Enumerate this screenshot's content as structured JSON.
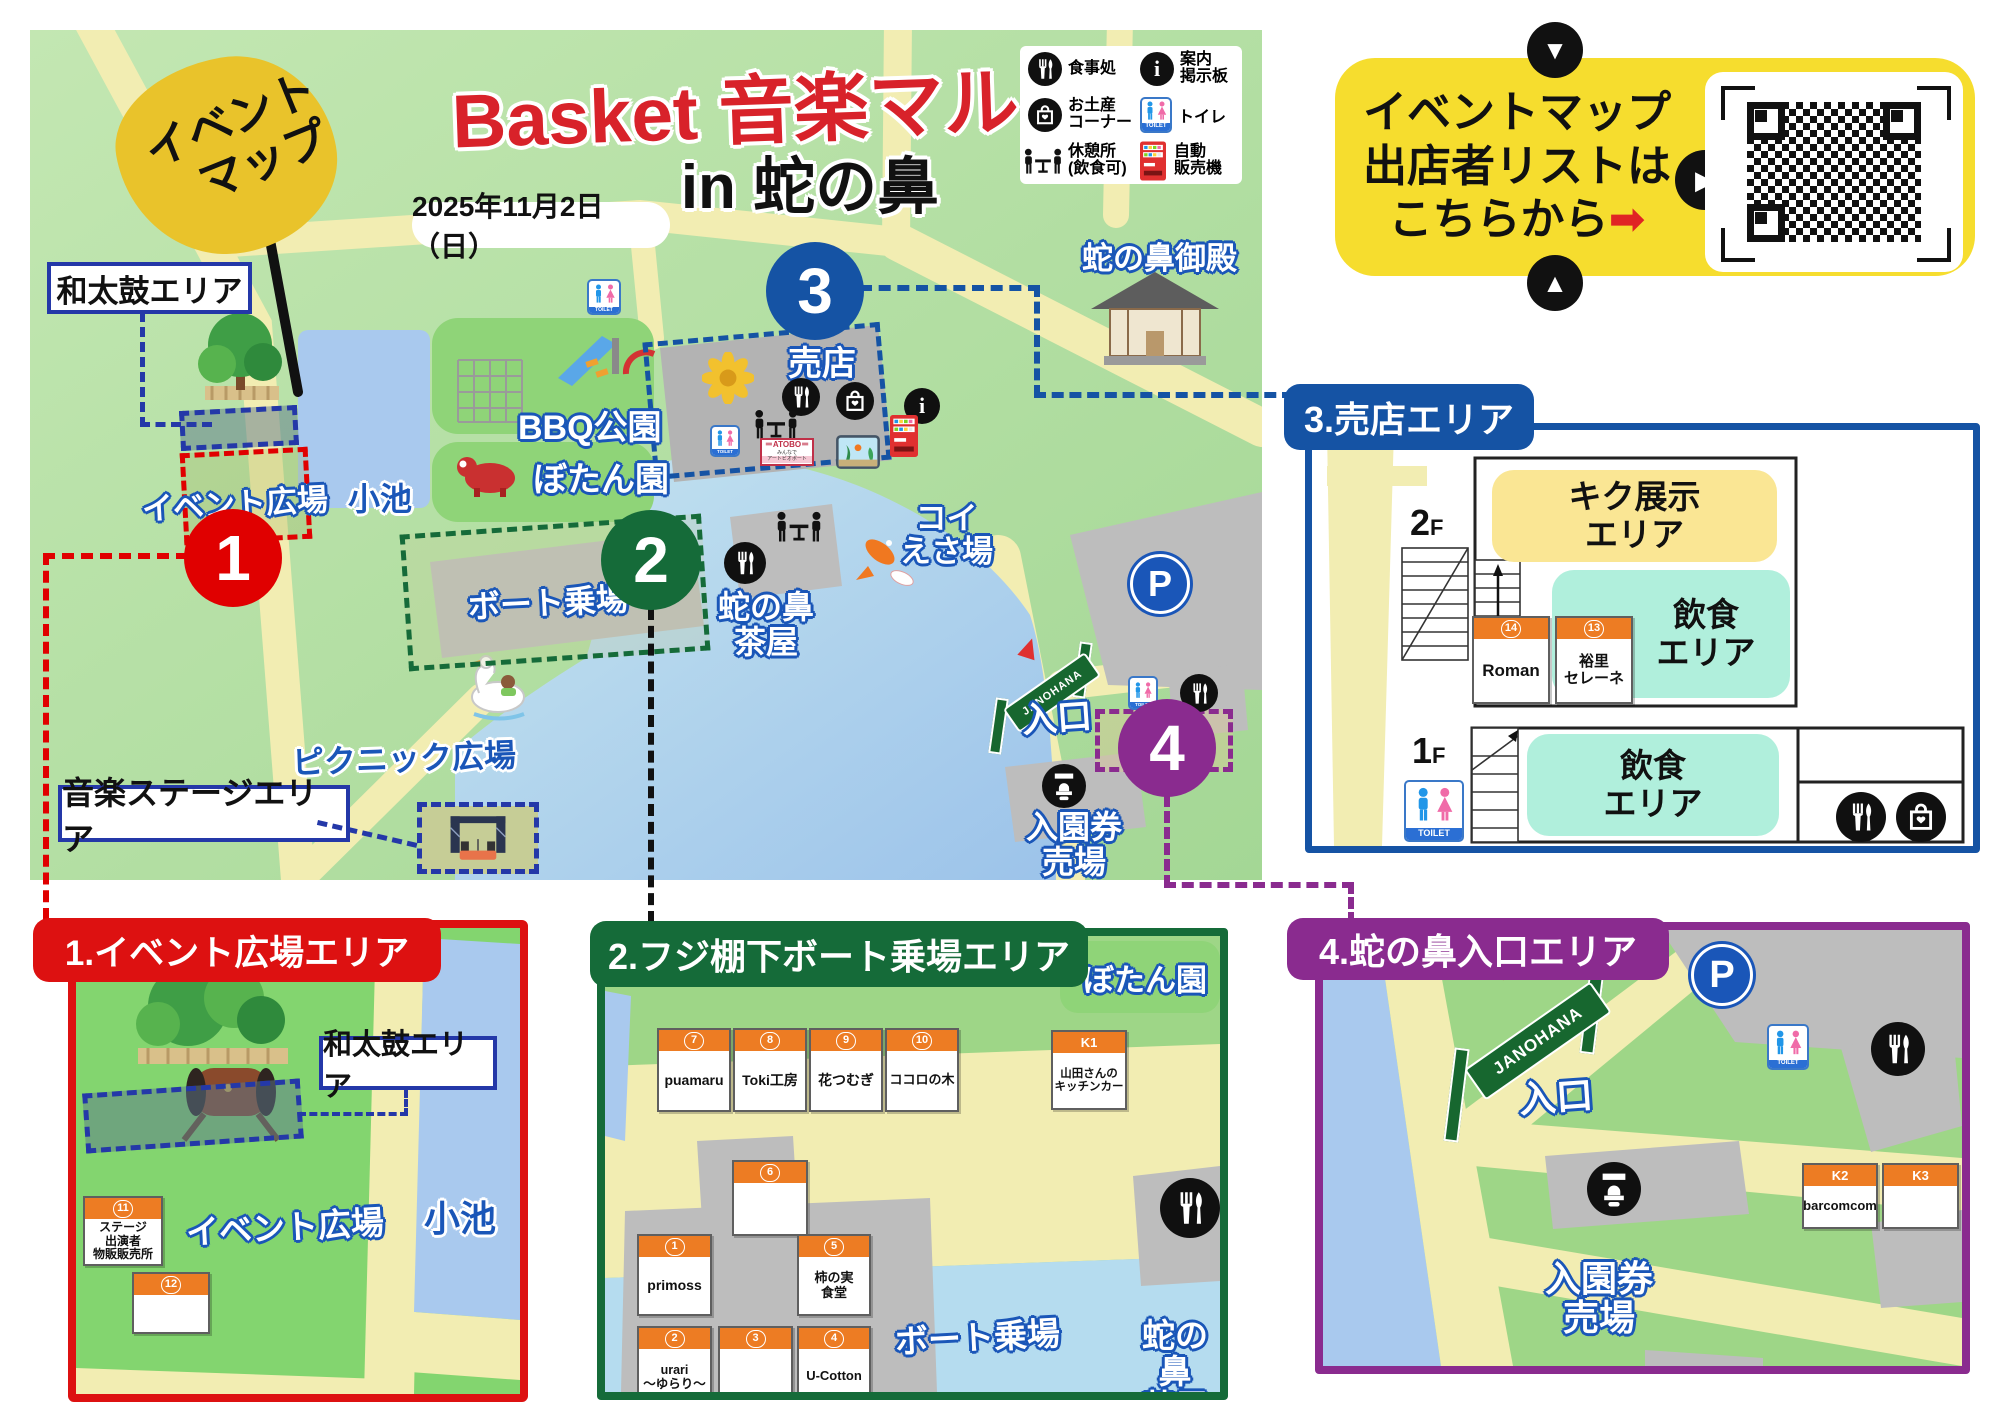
{
  "header": {
    "flag1": "イベント",
    "flag2": "マップ",
    "title_red": "Basket 音楽マルシェ",
    "title_black": "in 蛇の鼻",
    "date": "2025年11月2日（日）"
  },
  "legend": {
    "items": [
      {
        "icon": "meal-icon",
        "label": "食事処"
      },
      {
        "icon": "info-board-icon",
        "label": "案内\n掲示板"
      },
      {
        "icon": "souvenir-icon",
        "label": "お土産\nコーナー"
      },
      {
        "icon": "toilet-icon",
        "label": "トイレ"
      },
      {
        "icon": "rest-area-icon",
        "label": "休憩所\n(飲食可)"
      },
      {
        "icon": "vending-machine-icon",
        "label": "自動\n販売機"
      }
    ]
  },
  "qr": {
    "line1": "イベントマップ",
    "line2": "出店者リストは",
    "line3": "こちらから",
    "arrow": "➡"
  },
  "map": {
    "labels": {
      "wadaiko": "和太鼓エリア",
      "event_plaza": "イベント広場",
      "koike": "小池",
      "bbq": "BBQ公園",
      "botan": "ぼたん園",
      "baiten": "売店",
      "atobo1": "＝ATOBO＝",
      "atobo2": "みんなで",
      "atobo3": "アートビオポート",
      "koi": "コイ\nえさ場",
      "goten": "蛇の鼻御殿",
      "boat": "ボート乗場",
      "chaya": "蛇の鼻\n茶屋",
      "picnic": "ピクニック広場",
      "stage": "音楽ステージエリア",
      "gate": "JANOHANA",
      "entrance": "入口",
      "ticket": "入園券\n売場",
      "toilet": "TOILET",
      "parking": "P"
    },
    "markers": {
      "m1": "1",
      "m2": "2",
      "m3": "3",
      "m4": "4"
    }
  },
  "panels": {
    "p1": {
      "title": "1.イベント広場エリア",
      "wadaiko": "和太鼓エリア",
      "event_plaza": "イベント広場",
      "koike": "小池",
      "booths": {
        "b11": {
          "no": "11",
          "name": "ステージ\n出演者\n物販販売所"
        },
        "b12": {
          "no": "12",
          "name": ""
        }
      }
    },
    "p2": {
      "title": "2.フジ棚下ボート乗場エリア",
      "botan": "ぼたん園",
      "boat": "ボート乗場",
      "chaya": "蛇の鼻\n茶屋",
      "booths": {
        "b7": {
          "no": "7",
          "name": "puamaru"
        },
        "b8": {
          "no": "8",
          "name": "Toki工房"
        },
        "b9": {
          "no": "9",
          "name": "花つむぎ"
        },
        "b10": {
          "no": "10",
          "name": "ココロの木"
        },
        "k1": {
          "no": "K1",
          "name": "山田さんの\nキッチンカー"
        },
        "b6": {
          "no": "6",
          "name": ""
        },
        "b1": {
          "no": "1",
          "name": "primoss"
        },
        "b5": {
          "no": "5",
          "name": "柿の実\n食堂"
        },
        "b2": {
          "no": "2",
          "name": "urari\n〜ゆらり〜"
        },
        "b3": {
          "no": "3",
          "name": ""
        },
        "b4": {
          "no": "4",
          "name": "U-Cotton"
        }
      }
    },
    "p3": {
      "title": "3.売店エリア",
      "f2": "2",
      "f1": "1",
      "floor_suffix": "F",
      "kiku": "キク展示\nエリア",
      "dining": "飲食\nエリア",
      "toilet": "TOILET",
      "booths": {
        "b14": {
          "no": "14",
          "name": "Roman"
        },
        "b13": {
          "no": "13",
          "name": "裕里\nセレーネ"
        }
      }
    },
    "p4": {
      "title": "4.蛇の鼻入口エリア",
      "gate": "JANOHANA",
      "entrance": "入口",
      "parking": "P",
      "ticket": "入園券\n売場",
      "toilet": "TOILET",
      "booths": {
        "k2": {
          "no": "K2",
          "name": "barcomcom"
        },
        "k3": {
          "no": "K3",
          "name": ""
        }
      }
    }
  }
}
